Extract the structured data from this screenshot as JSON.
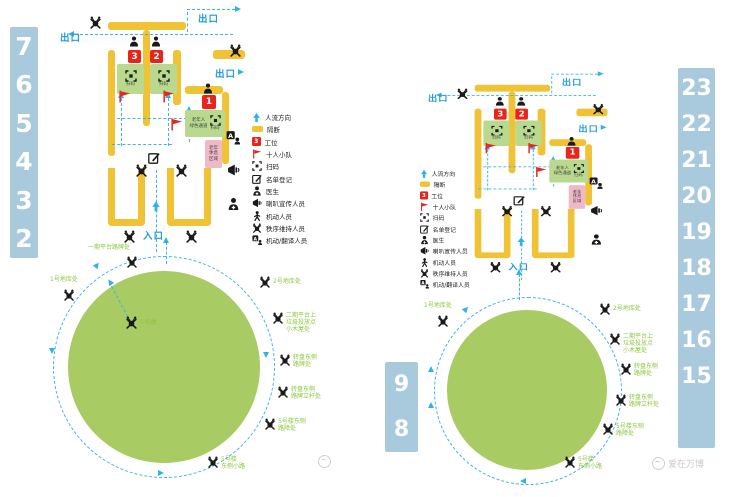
{
  "colors": {
    "partition_yellow": "#f0c235",
    "zone_green": "#b9d98e",
    "circle_green": "#a8cb63",
    "flow_cyan": "#3ab5e5",
    "site_label_green": "#8dc63f",
    "station_red": "#e8241d",
    "rest_pink": "#f0b9c8",
    "number_bar_blue": "#a9c9dc",
    "exit_blue": "#1f9cd6",
    "watermark_gray": "#c9c9c9"
  },
  "plan": {
    "exit_label": "出口",
    "entrance_label": "入口",
    "station_3": "3",
    "station_2": "2",
    "station_1": "1",
    "scan_label": "扫码",
    "elderly_channel": "老年人\n绿色通道",
    "rest_area": "老年\n休息\n区域"
  },
  "legend": {
    "items": [
      {
        "icon": "flow-arrow-icon",
        "label": "人流方向"
      },
      {
        "icon": "partition-icon",
        "label": "隔断"
      },
      {
        "icon": "station-icon",
        "label": "工位",
        "badge": "3"
      },
      {
        "icon": "flag-icon",
        "label": "十人小队"
      },
      {
        "icon": "scan-icon",
        "label": "扫码"
      },
      {
        "icon": "register-icon",
        "label": "名单登记"
      },
      {
        "icon": "doctor-icon",
        "label": "医生"
      },
      {
        "icon": "megaphone-icon",
        "label": "喇叭宣传人员"
      },
      {
        "icon": "mobile-person-icon",
        "label": "机动人员"
      },
      {
        "icon": "order-keeper-icon",
        "label": "秩序维持人员"
      },
      {
        "icon": "translator-icon",
        "label": "机动/翻译人员"
      }
    ]
  },
  "site_labels": {
    "phase1_platform": "一期平台路牌处",
    "garage_1": "1号地库处",
    "garage_2": "2号地库处",
    "phase2_platform": "二期平台上\n垃圾投放点\n小木屋处",
    "roundabout_sign": "转盘东侧\n路牌处",
    "roundabout_pole": "转盘东侧\n路牌立杆处",
    "bldg5_east_barrier": "5号楼东侧\n路障处",
    "bldg5_east_path": "5号楼\n东侧小路",
    "bldg5": "5号楼"
  },
  "number_bars": {
    "left": [
      "7",
      "6",
      "5",
      "4",
      "3",
      "2"
    ],
    "mid": [
      "9",
      "8"
    ],
    "right": [
      "23",
      "22",
      "21",
      "20",
      "19",
      "18",
      "17",
      "16",
      "15"
    ]
  },
  "watermark": {
    "text": "爱在万博"
  }
}
